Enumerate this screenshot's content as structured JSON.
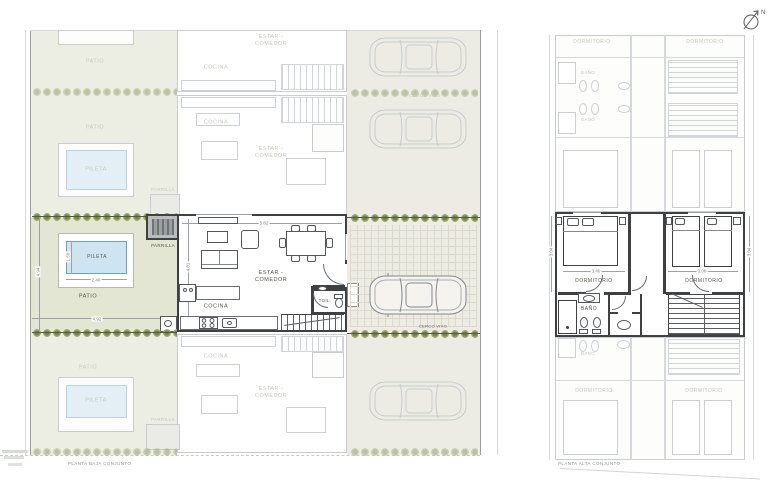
{
  "sheet": {
    "north_label": "N",
    "left_plan": {
      "title": "PLANTA BAJA CONJUNTO",
      "labels": {
        "patio": "PATIO",
        "pileta": "PILETA",
        "parrilla": "PARRILLA",
        "cocina": "COCINA",
        "estar_comedor": "ESTAR - COMEDOR",
        "toilette": "TOIL.",
        "cerco_vivo": "CERCO VIVO"
      },
      "dims": {
        "pool_width": "2.40",
        "pool_depth": "1.50",
        "patio_width": "4.92",
        "patio_depth": "4.94",
        "living_width": "5.82",
        "living_depth": "4.81"
      }
    },
    "right_plan": {
      "title": "PLANTA ALTA CONJUNTO",
      "labels": {
        "dormitorio": "DORMITORIO",
        "bano": "BAÑO"
      },
      "dims": {
        "bedroom1_width": "3.40",
        "bedroom2_width": "3.08",
        "bedroom_depth": "3.04"
      }
    }
  }
}
